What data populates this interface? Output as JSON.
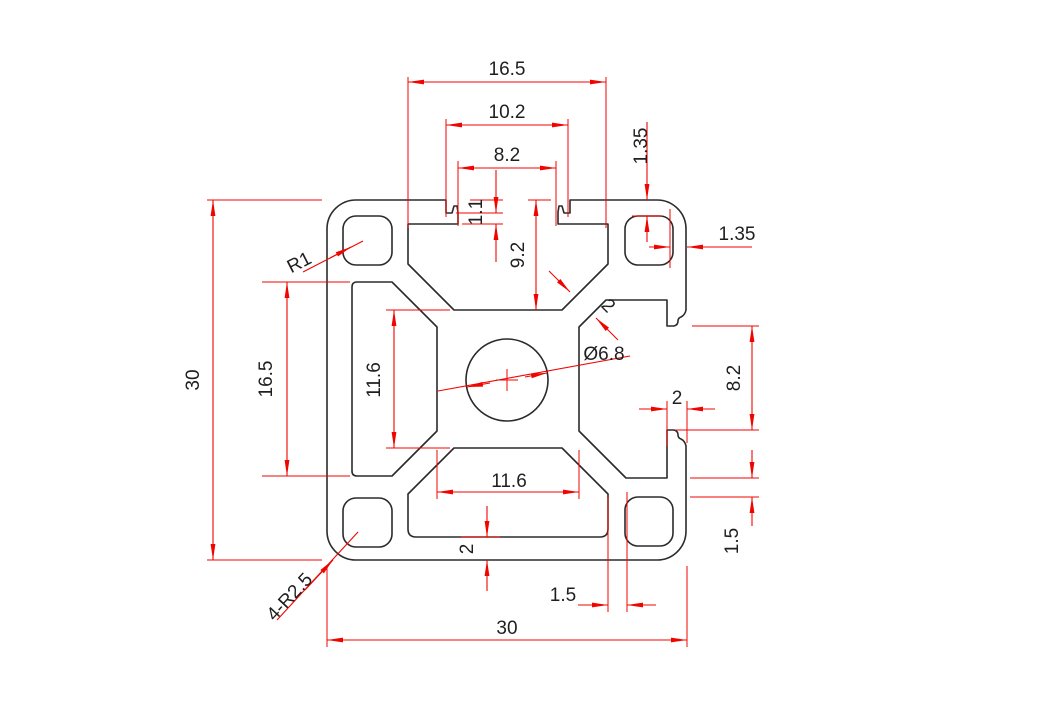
{
  "drawing": {
    "type": "technical-drawing",
    "subject": "30x30 aluminium extrusion profile cross-section",
    "background_color": "#ffffff",
    "profile_line_color": "#2b2b2b",
    "dimension_line_color": "#f00400",
    "text_color": "#1f1f1f",
    "dimensions": {
      "top_cavity_width": "16.5",
      "top_step_width": "10.2",
      "top_opening_width": "8.2",
      "top_lip_step": "1.1",
      "slot_depth": "9.2",
      "corner_hole_top_wall": "1.35",
      "corner_hole_side_wall": "1.35",
      "corner_hole_radius": "R1",
      "overall_height": "30",
      "side_cavity_height": "16.5",
      "core_height": "11.6",
      "web_thickness": "2",
      "center_hole_diameter": "Ø6.8",
      "right_slot_opening": "8.2",
      "hook_wall_thickness": "2",
      "core_width": "11.6",
      "bottom_wall_thickness": "2",
      "boss_wall_bottom": "1.5",
      "boss_wall_right": "1.5",
      "outer_corner_radius": "4-R2.5",
      "overall_width": "30"
    }
  }
}
